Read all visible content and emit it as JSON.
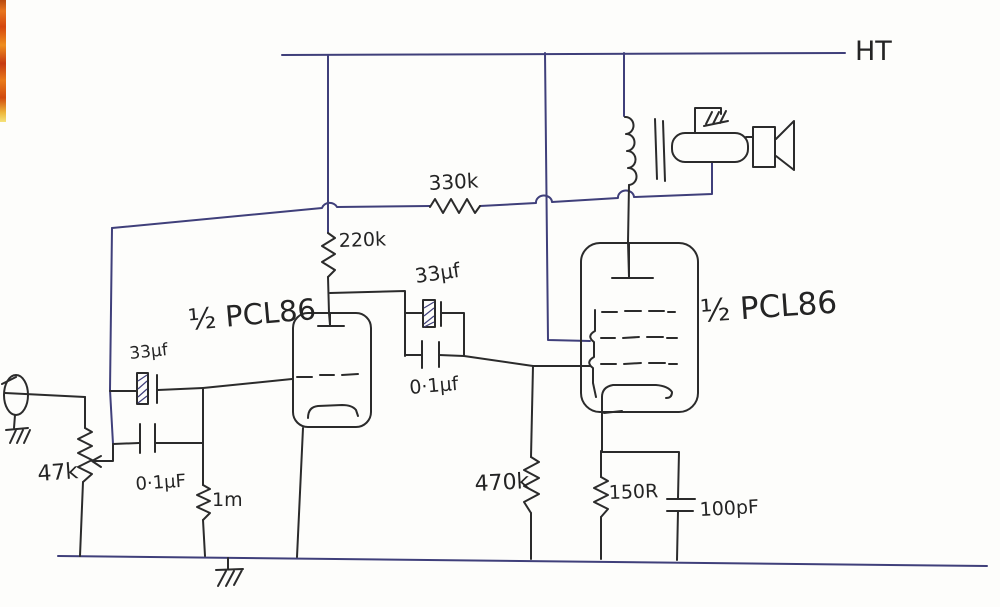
{
  "palette": {
    "paper": "#fdfdfb",
    "ink": "#2b2b2b",
    "routing_ink": "#3f3f7a",
    "scan_strip_orange": "#e8751f"
  },
  "labels": {
    "ht_rail": "HT",
    "feedback_resistor": "330k",
    "anode_resistor": "220k",
    "coupling_cap_electrolytic": "33μf",
    "coupling_cap_film": "0·1μf",
    "tube_left": "½ PCL86",
    "tube_right": "½ PCL86",
    "input_cap_electrolytic": "33μf",
    "input_cap_film": "0·1μF",
    "grid_resistor_input": "1m",
    "volume_pot": "47k",
    "grid_resistor_pentode": "470k",
    "cathode_resistor": "150R",
    "cathode_cap": "100pF"
  }
}
